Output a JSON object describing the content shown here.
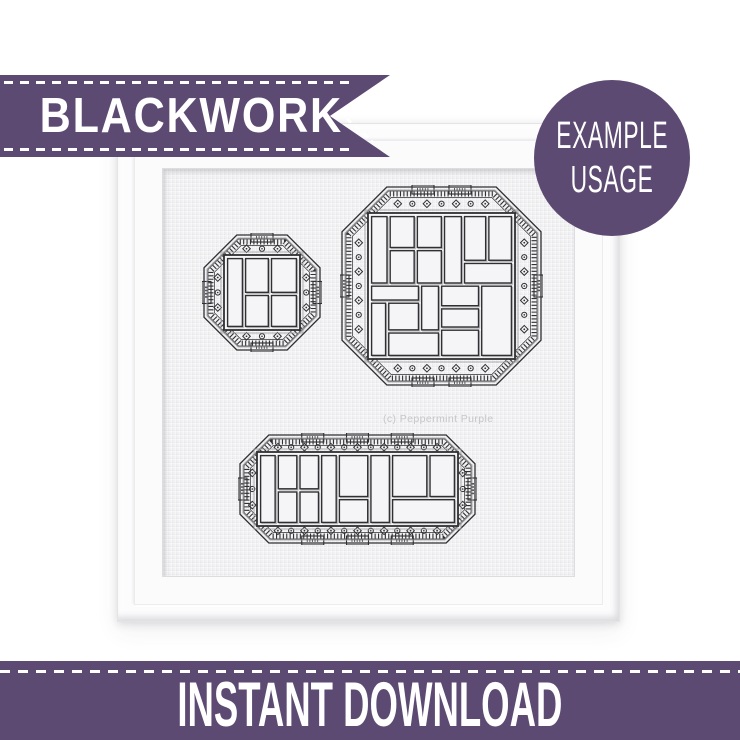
{
  "title_ribbon": {
    "label": "BLACKWORK"
  },
  "example_badge": {
    "line1": "EXAMPLE",
    "line2": "USAGE"
  },
  "bottom_banner": {
    "label": "INSTANT DOWNLOAD"
  },
  "artwork": {
    "watermark": "(c) Peppermint Purple",
    "patterns": [
      {
        "name": "small-square",
        "x": 39,
        "y": 64,
        "w": 120,
        "h": 119,
        "inset": 24,
        "corner": 34,
        "tabs_h": 1,
        "tabs_v": 1,
        "cells": [
          [
            0,
            0,
            25,
            100
          ],
          [
            25,
            0,
            36,
            52
          ],
          [
            61,
            0,
            39,
            52
          ],
          [
            25,
            52,
            36,
            48
          ],
          [
            61,
            52,
            39,
            48
          ]
        ]
      },
      {
        "name": "large-square",
        "x": 177,
        "y": 16,
        "w": 203,
        "h": 202,
        "inset": 30,
        "corner": 46,
        "tabs_h": 2,
        "tabs_v": 1,
        "cells": [
          [
            0,
            0,
            13,
            49
          ],
          [
            13,
            0,
            19,
            24
          ],
          [
            32,
            0,
            19,
            24
          ],
          [
            13,
            24,
            19,
            25
          ],
          [
            32,
            24,
            19,
            25
          ],
          [
            51,
            0,
            14,
            49
          ],
          [
            65,
            0,
            17,
            33
          ],
          [
            82,
            0,
            18,
            33
          ],
          [
            65,
            33,
            35,
            16
          ],
          [
            0,
            49,
            35,
            12
          ],
          [
            0,
            61,
            12,
            39
          ],
          [
            12,
            61,
            23,
            21
          ],
          [
            12,
            82,
            37,
            18
          ],
          [
            35,
            49,
            14,
            33
          ],
          [
            49,
            49,
            28,
            16
          ],
          [
            49,
            65,
            28,
            15
          ],
          [
            49,
            80,
            28,
            20
          ],
          [
            77,
            49,
            23,
            51
          ]
        ]
      },
      {
        "name": "wide-rect",
        "x": 75,
        "y": 264,
        "w": 239,
        "h": 112,
        "inset": 21,
        "corner": 30,
        "tabs_h": 3,
        "tabs_v": 1,
        "cells": [
          [
            0,
            0,
            9,
            100
          ],
          [
            9,
            0,
            11,
            52
          ],
          [
            20,
            0,
            11,
            52
          ],
          [
            9,
            52,
            11,
            48
          ],
          [
            20,
            52,
            11,
            48
          ],
          [
            31,
            0,
            9,
            100
          ],
          [
            40,
            0,
            16,
            63
          ],
          [
            40,
            63,
            16,
            37
          ],
          [
            56,
            0,
            11,
            100
          ],
          [
            67,
            0,
            19,
            63
          ],
          [
            86,
            0,
            14,
            63
          ],
          [
            67,
            63,
            33,
            37
          ]
        ]
      }
    ]
  },
  "colors": {
    "purple": "#5c4a73",
    "stitch": "#303032",
    "stitch_light": "#9a9a9f",
    "shadow_gray": "#bcbcc0",
    "fabric": "#f1f1f4",
    "cell_fill": "#f5f5f7",
    "watermark": "#c7c7ca"
  }
}
